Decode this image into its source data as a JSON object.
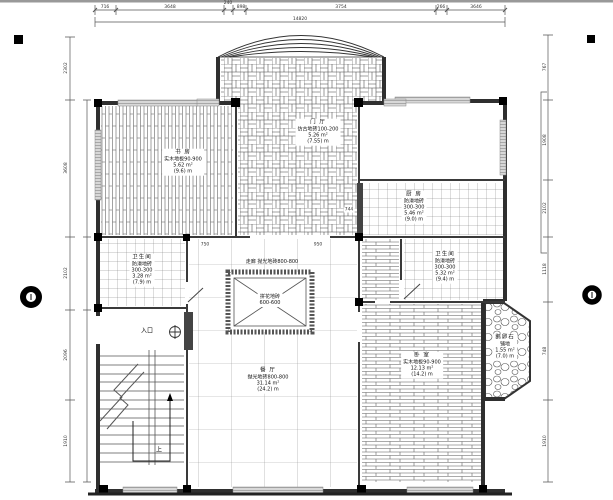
{
  "title": "一层地面铺装平面图",
  "labels": {
    "entry": "入口",
    "up": "上",
    "corridor": "走廊 抛光地砖800-800",
    "medallion1": "拼花地砖",
    "medallion2": "600-600"
  },
  "rooms": {
    "study": {
      "name": "书 房",
      "spec": "实木地板90-900",
      "area": "5.62 m²",
      "perimeter": "(9.6) m"
    },
    "foyer": {
      "name": "门 厅",
      "spec": "仿古地砖100-200",
      "area": "5.26 m²",
      "perimeter": "(7.55) m"
    },
    "kitchen": {
      "name": "厨 房",
      "spec": "防滑地砖",
      "size": "300-300",
      "area": "5.46 m²",
      "perimeter": "(9.0) m"
    },
    "bath1": {
      "name": "卫生间",
      "spec": "防滑地砖",
      "size": "300-300",
      "area": "3.28 m²",
      "perimeter": "(7.9) m"
    },
    "bath2": {
      "name": "卫生间",
      "spec": "防滑地砖",
      "size": "300-300",
      "area": "5.32 m²",
      "perimeter": "(9.4) m"
    },
    "dining": {
      "name": "餐 厅",
      "spec": "抛光地砖800-800",
      "area": "31.14 m²",
      "perimeter": "(24.2) m"
    },
    "bedroom": {
      "name": "卧 室",
      "spec": "实木地板90-900",
      "area": "12.13 m²",
      "perimeter": "(14.2) m"
    },
    "pebble": {
      "name": "鹅卵石",
      "spec": "铺地",
      "area": "1.55 m²",
      "perimeter": "(7.0) m"
    }
  },
  "dims": {
    "top": [
      "716",
      "3648",
      "240",
      "898",
      "3754",
      "266",
      "3646"
    ],
    "top_total": "14820",
    "left": [
      "2302",
      "3608",
      "2102",
      "2096",
      "1910"
    ],
    "right": [
      "767",
      "1908",
      "2102",
      "1118",
      "748",
      "1910"
    ],
    "inline": [
      "744",
      "750",
      "950"
    ]
  },
  "colors": {
    "wall": "#2f2f2f",
    "hatch": "#555555",
    "window_fill": "#cccccc",
    "background": "#ffffff"
  }
}
